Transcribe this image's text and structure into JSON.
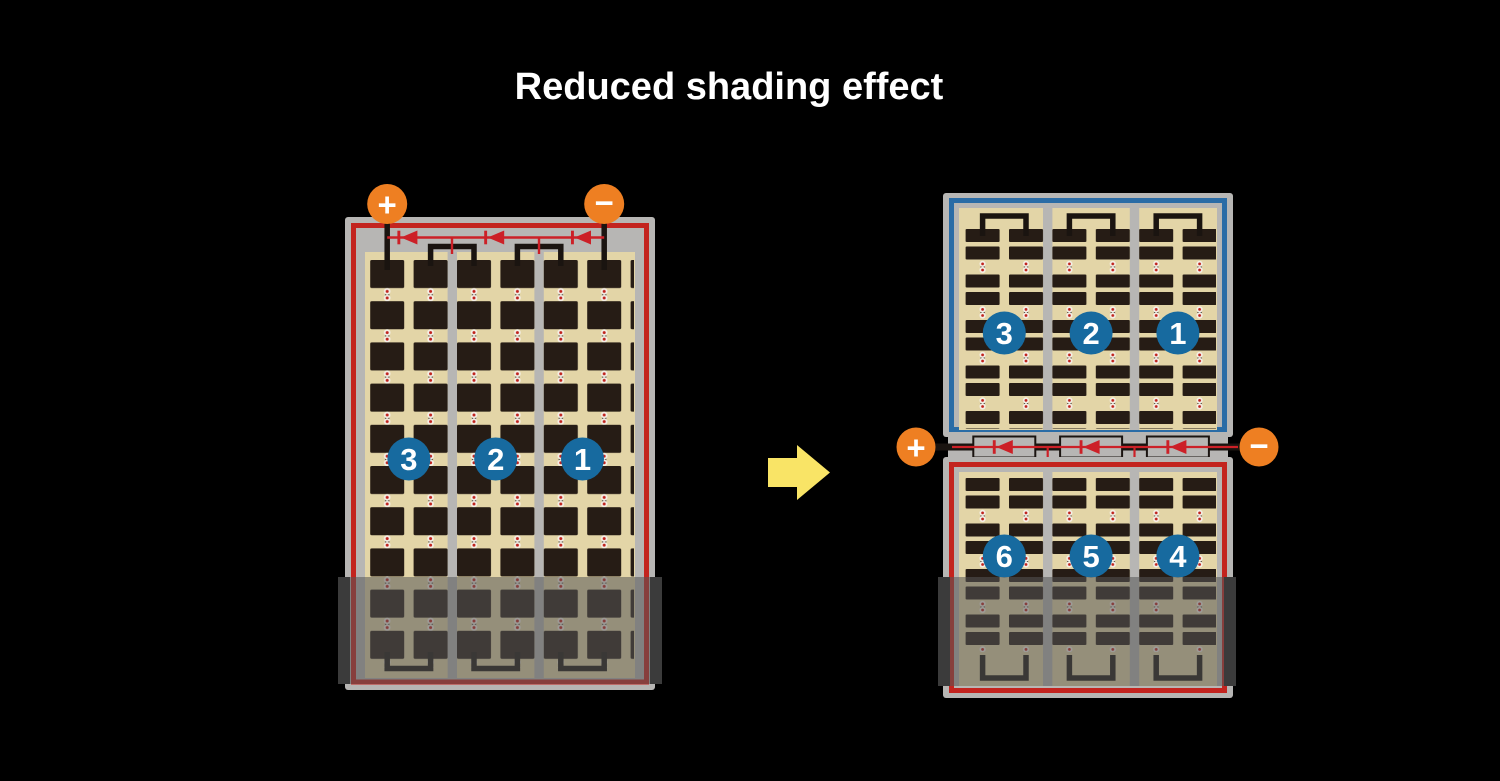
{
  "title": "Reduced shading effect",
  "left_module": {
    "positive_label": "+",
    "negative_label": "−",
    "cell_group_labels": [
      "3",
      "2",
      "1"
    ]
  },
  "right_module": {
    "positive_label": "+",
    "negative_label": "−",
    "top_cell_group_labels": [
      "3",
      "2",
      "1"
    ],
    "bottom_cell_group_labels": [
      "6",
      "5",
      "4"
    ]
  },
  "colors": {
    "background": "#000000",
    "title_text": "#ffffff",
    "frame_gray": "#b7b6b4",
    "border_red": "#c3241f",
    "border_blue": "#2a6ca6",
    "cell_tan": "#e3d5a7",
    "cell_dark": "#261c15",
    "wire_black": "#1a1410",
    "diode_red": "#cc2027",
    "terminal_orange": "#ee7f22",
    "badge_blue": "#176a9f",
    "arrow_yellow": "#f9e466",
    "shade_gray": "#565656"
  }
}
